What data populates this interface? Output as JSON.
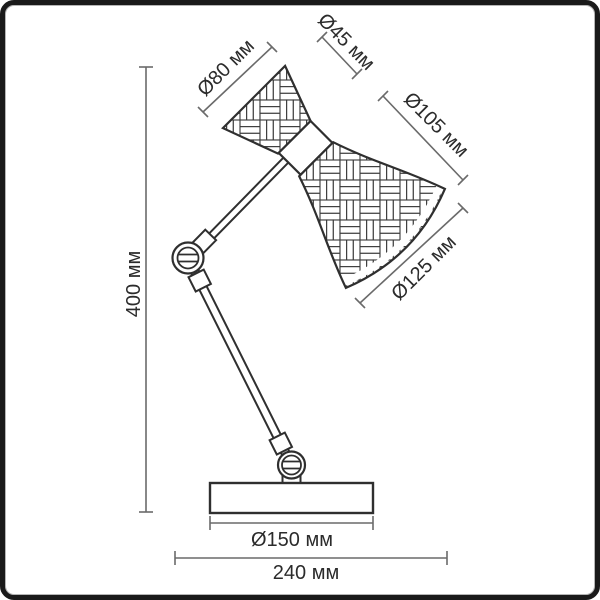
{
  "unit": "мм",
  "dimensions": {
    "shade_back": {
      "label": "Ø80 мм",
      "value": 80
    },
    "neck": {
      "label": "Ø45 мм",
      "value": 45
    },
    "shade_side": {
      "label": "Ø105 мм",
      "value": 105
    },
    "shade_opening": {
      "label": "Ø125 мм",
      "value": 125
    },
    "height": {
      "label": "400 мм",
      "value": 400
    },
    "base_diameter": {
      "label": "Ø150 мм",
      "value": 150
    },
    "overall_depth": {
      "label": "240 мм",
      "value": 240
    }
  },
  "colors": {
    "outline": "#2f2f2f",
    "dimension_line": "#6a6a6a",
    "text": "#2b2b2b",
    "background": "#ffffff",
    "frame": "#1a1a1a"
  }
}
